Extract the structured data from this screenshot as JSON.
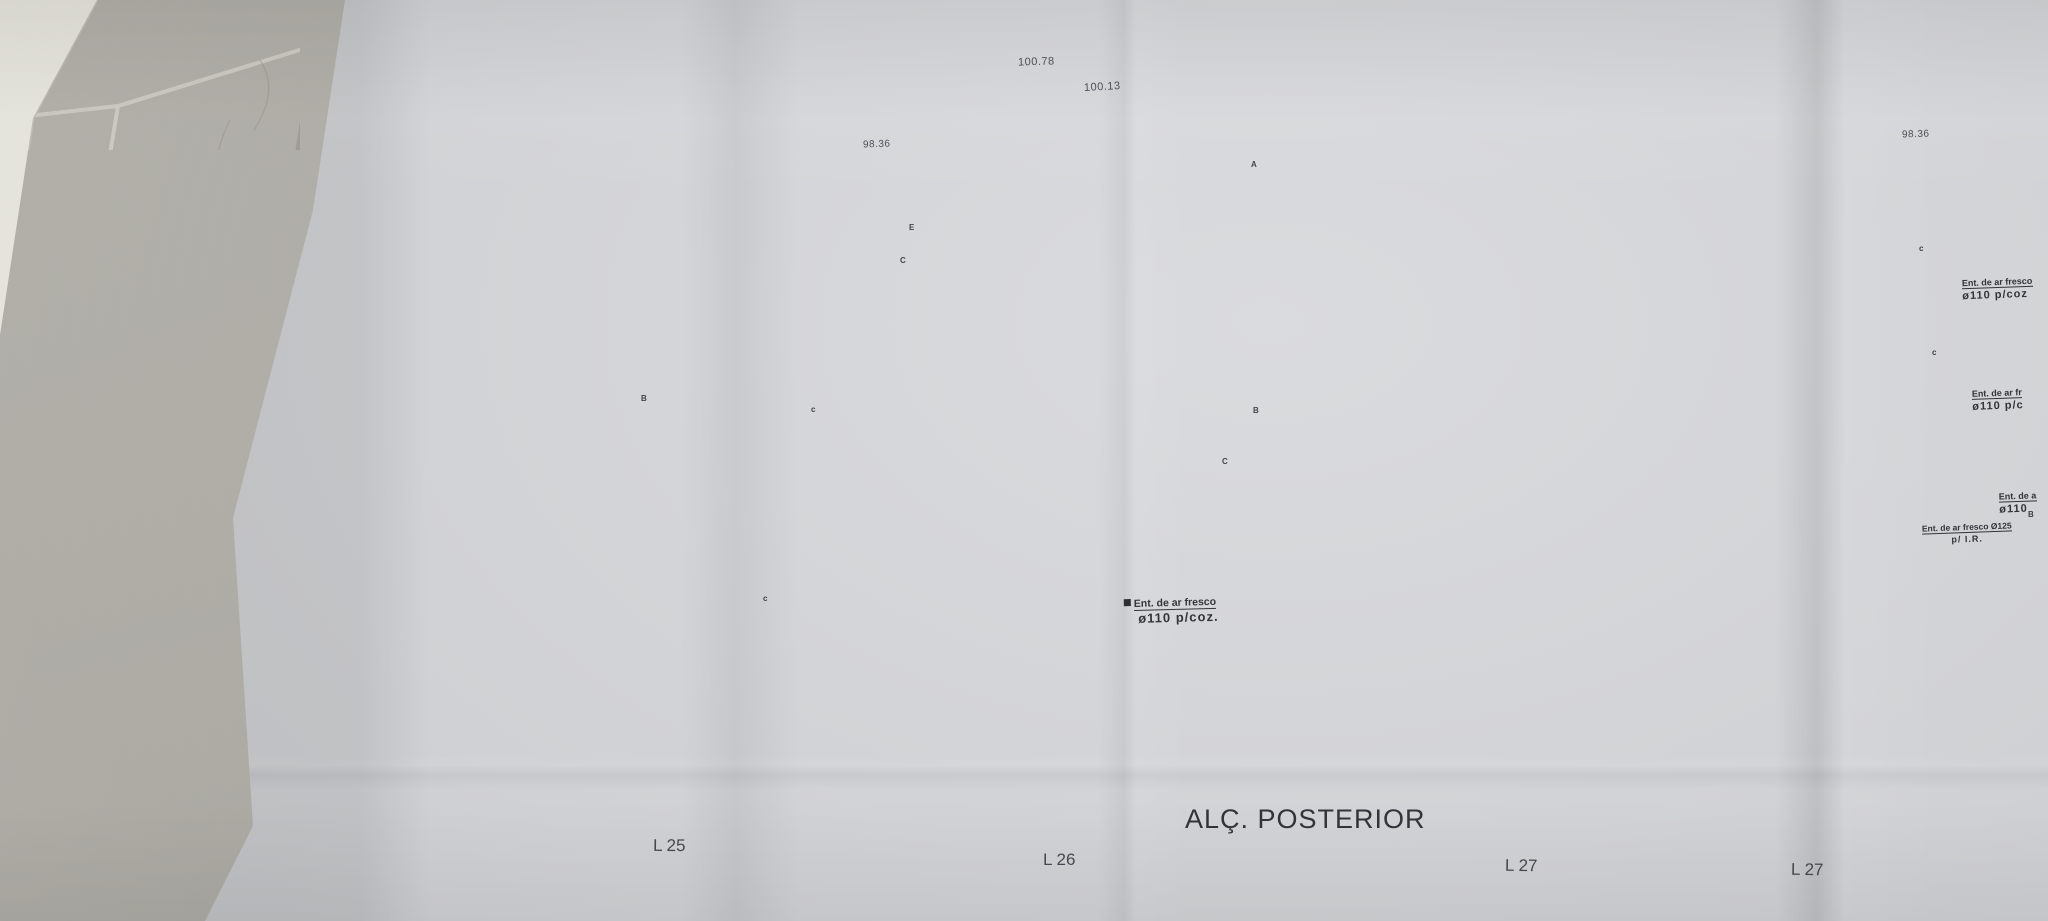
{
  "drawing": {
    "title": "ALÇ. POSTERIOR",
    "dimension_labels": {
      "rooftop_left": "100.78",
      "rooftop_right": "100.13",
      "roof_left": "98.36",
      "roof_right": "98.36"
    },
    "annotations": {
      "center": {
        "line1": "Ent. de ar fresco",
        "line2": "ø110 p/coz."
      },
      "right_top": {
        "line1": "Ent. de ar fresco",
        "line2": "ø110 p/coz"
      },
      "right_middle": {
        "line1": "Ent. de ar fr",
        "line2": "ø110 p/c"
      },
      "right_lower": {
        "line1": "Ent. de a",
        "line2": "ø110"
      },
      "right_ground": {
        "line1": "Ent. de ar fresco Ø125",
        "line2": "p/ I.R."
      }
    },
    "lot_labels": {
      "l25": "L 25",
      "l26": "L 26",
      "l27_a": "L 27",
      "l27_b": "L 27"
    },
    "reference_letters": {
      "la": "A",
      "le": "E",
      "lc1": "C",
      "lb1": "B",
      "lc2": "c",
      "lb2": "B",
      "lc3": "C",
      "lc4": "c",
      "lc5": "c",
      "lc6": "c",
      "lb3": "B"
    },
    "colors": {
      "paper": "#d8d9dc",
      "linework": "#565962",
      "ground_fill": "#9b9ea2",
      "vegetation": "#58a13e",
      "tile": "#b1afa8",
      "dark_object": "#141418"
    }
  }
}
